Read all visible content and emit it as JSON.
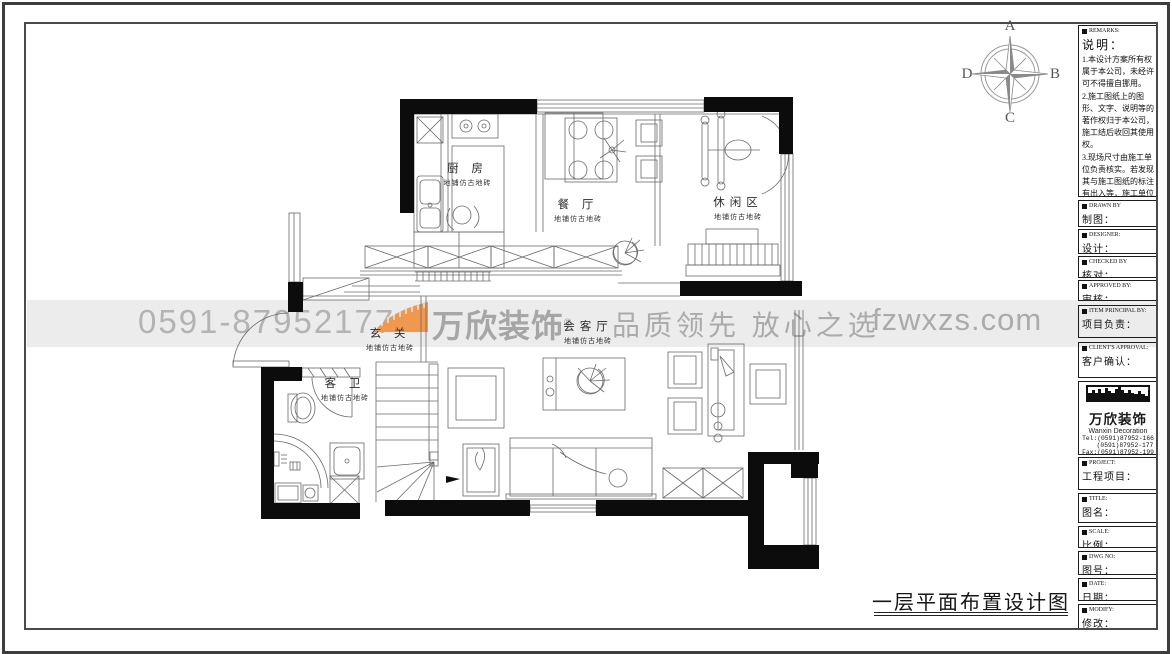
{
  "sheet": {
    "title": "一层平面布置设计图"
  },
  "compass": {
    "north": "A",
    "east": "B",
    "south": "C",
    "west": "D"
  },
  "watermark": {
    "phone": "0591-87952177",
    "brand": "万欣装饰",
    "reg": "®",
    "slogan": "品质领先 放心之选",
    "website": "fzwxzs.com",
    "accent_orange": "#F0984E",
    "gray": "#B3B3B3"
  },
  "rooms": {
    "kitchen": {
      "name": "厨 房",
      "floor": "地铺仿古地砖"
    },
    "dining": {
      "name": "餐 厅",
      "floor": "地铺仿古地砖"
    },
    "leisure": {
      "name": "休闲区",
      "floor": "地铺仿古地砖"
    },
    "entry": {
      "name": "玄 关",
      "floor": "地铺仿古地砖"
    },
    "living": {
      "name": "会客厅",
      "floor": "地铺仿古地砖"
    },
    "bath": {
      "name": "客 卫",
      "floor": "地铺仿古地砖"
    }
  },
  "titleblock": {
    "remarks": {
      "en": "REMARKS:",
      "zh": "说明：",
      "lines": [
        "1.本设计方案所有权属于本公司，未经许可不得擅自挪用。",
        "2.施工图纸上的图形、文字、说明等的著作权归于本公司，施工结后收回其使用权。",
        "3.现场尺寸由施工单位负责核实。若发现其与施工图纸的标注有出入等，施工单位有责任立即通知本公司，否则施工单位须承担所有责任。",
        "4.本设计方案是依客户要求设计，经客户签字即视为同意认可，不得随意更改。"
      ]
    },
    "fields": [
      {
        "en": "DRAWN BY",
        "zh": "制图："
      },
      {
        "en": "DESIGNER:",
        "zh": "设计："
      },
      {
        "en": "CHECKED BY",
        "zh": "核对："
      },
      {
        "en": "APPROVED BY:",
        "zh": "审核："
      },
      {
        "en": "ITEM PRINCIPAL BY:",
        "zh": "项目负责："
      },
      {
        "en": "CLIENT'S APPROVAL:",
        "zh": "客户确认："
      },
      {
        "en": "PROJECT:",
        "zh": "工程项目："
      },
      {
        "en": "TITLE:",
        "zh": "图名："
      },
      {
        "en": "SCALE:",
        "zh": "比例："
      },
      {
        "en": "DWG NO:",
        "zh": "图号："
      },
      {
        "en": "DATE:",
        "zh": "日期："
      },
      {
        "en": "MODIFY:",
        "zh": "修改："
      }
    ],
    "company": {
      "name": "万欣装饰",
      "name_en": "Wanxin Decoration",
      "reg": "®",
      "tel1": "Tel:(0591)87952-166",
      "tel2": "(0591)87952-177",
      "fax": "Fax:(0591)87952-199",
      "web": "Web:WWW.fzwxzs.com"
    }
  }
}
